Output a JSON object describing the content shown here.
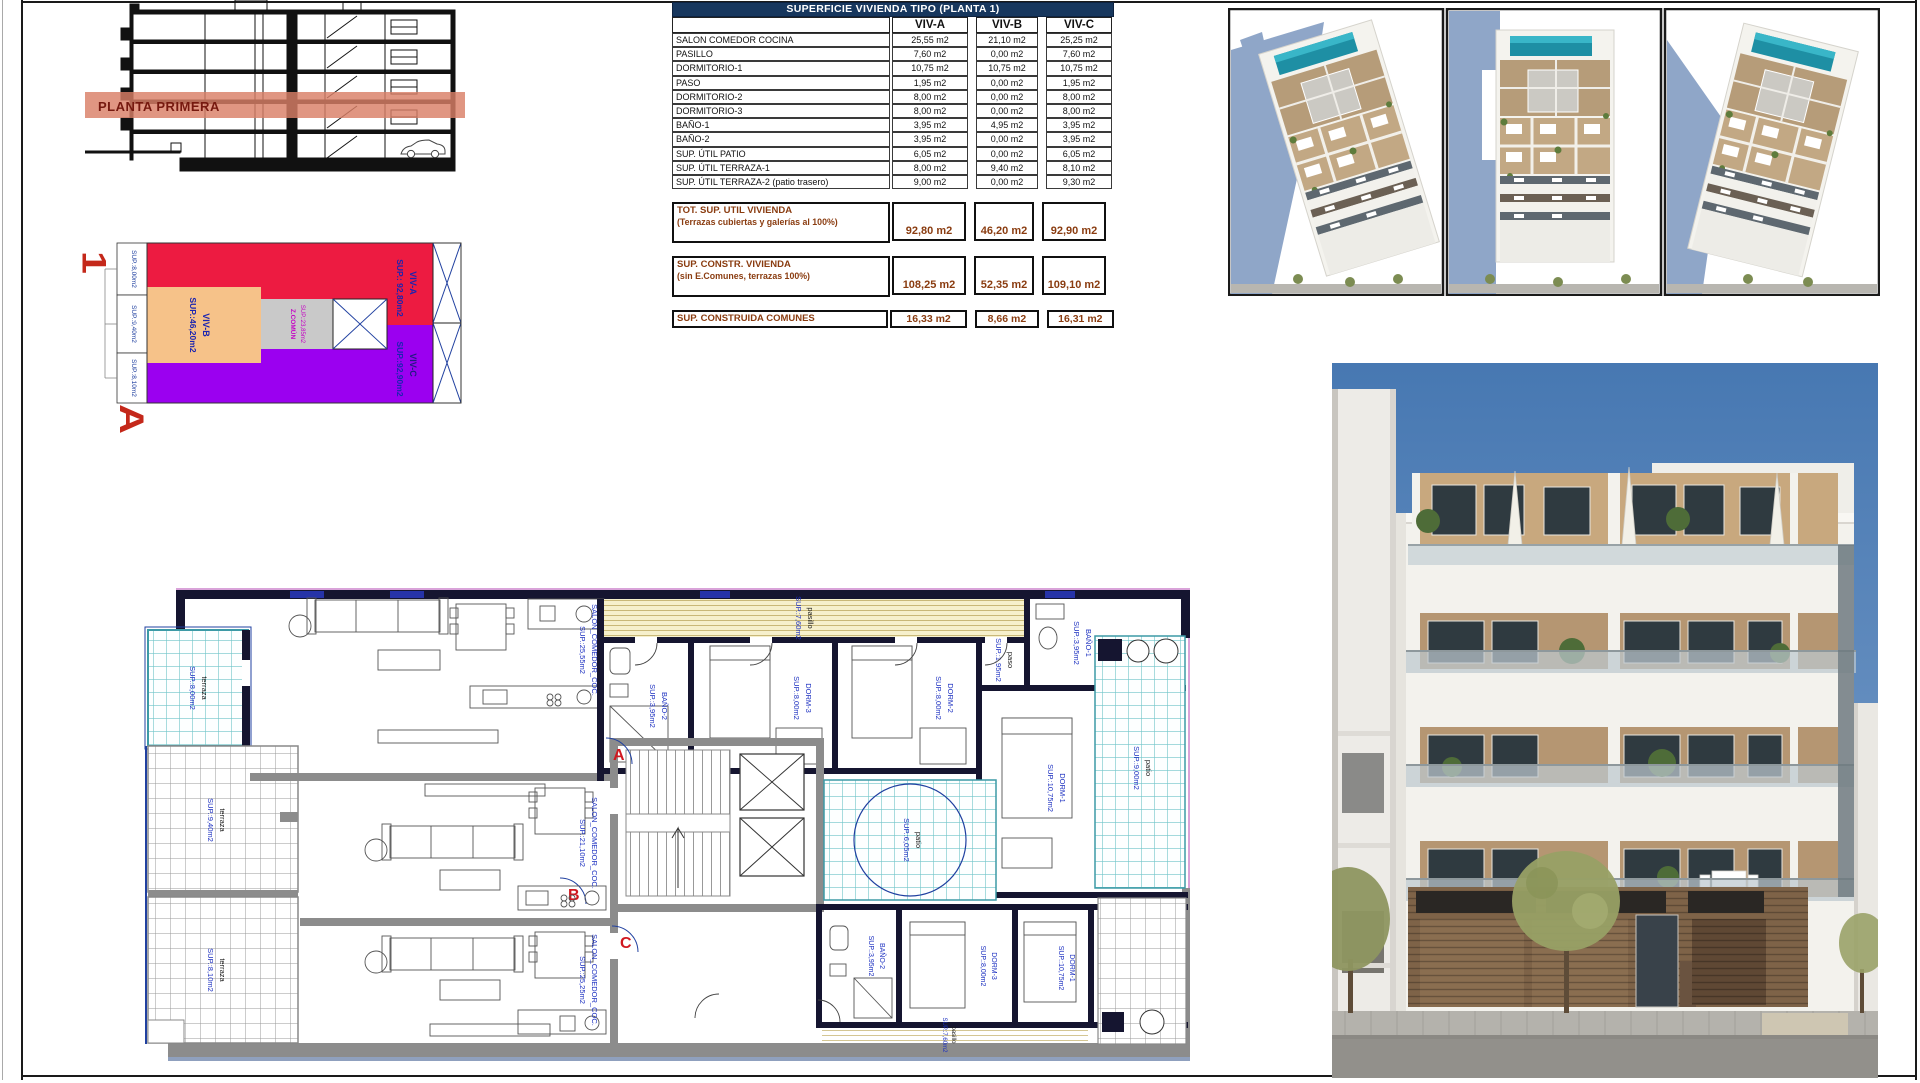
{
  "section": {
    "band_label": "PLANTA PRIMERA"
  },
  "key_plan": {
    "title": "PLANTA 1",
    "viv_a": {
      "name": "VIV-A",
      "sup": "SUP.: 92,80m2"
    },
    "viv_b": {
      "name": "VIV-B",
      "sup": "SUP.:46,20m2"
    },
    "viv_c": {
      "name": "VIV-C",
      "sup": "SUP.:92,90m2"
    },
    "z_comun": {
      "name": "Z.COMÚN",
      "sup": "SUP.:23,85m2"
    },
    "edge_labels": [
      "SUP.:8,00m2",
      "SUP.:9,40m2",
      "SUP.:8,10m2"
    ],
    "colors": {
      "viv_a": "#ED1B41",
      "viv_b": "#F6C289",
      "viv_c": "#9B00F0",
      "z_comun": "#C9C9C9"
    }
  },
  "table": {
    "title": "SUPERFICIE VIVIENDA TIPO (PLANTA 1)",
    "columns": [
      "VIV-A",
      "VIV-B",
      "VIV-C"
    ],
    "rows": [
      {
        "label": "SALON COMEDOR COCINA",
        "a": "25,55 m2",
        "b": "21,10 m2",
        "c": "25,25 m2"
      },
      {
        "label": "PASILLO",
        "a": "7,60 m2",
        "b": "0,00 m2",
        "c": "7,60 m2"
      },
      {
        "label": "DORMITORIO-1",
        "a": "10,75 m2",
        "b": "10,75 m2",
        "c": "10,75 m2"
      },
      {
        "label": "PASO",
        "a": "1,95 m2",
        "b": "0,00 m2",
        "c": "1,95 m2"
      },
      {
        "label": "DORMITORIO-2",
        "a": "8,00 m2",
        "b": "0,00 m2",
        "c": "8,00 m2"
      },
      {
        "label": "DORMITORIO-3",
        "a": "8,00 m2",
        "b": "0,00 m2",
        "c": "8,00 m2"
      },
      {
        "label": "BAÑO-1",
        "a": "3,95 m2",
        "b": "4,95 m2",
        "c": "3,95 m2"
      },
      {
        "label": "BAÑO-2",
        "a": "3,95 m2",
        "b": "0,00 m2",
        "c": "3,95 m2"
      },
      {
        "label": "SUP. ÚTIL PATIO",
        "a": "6,05 m2",
        "b": "0,00 m2",
        "c": "6,05 m2"
      },
      {
        "label": "SUP. ÚTIL TERRAZA-1",
        "a": "8,00 m2",
        "b": "9,40 m2",
        "c": "8,10 m2"
      },
      {
        "label": "SUP. ÚTIL TERRAZA-2 (patio trasero)",
        "a": "9,00 m2",
        "b": "0,00 m2",
        "c": "9,30 m2"
      }
    ],
    "totals": [
      {
        "label": "TOT. SUP. UTIL VIVIENDA",
        "sublabel": "(Terrazas cubiertas y galerías al 100%)",
        "a": "92,80 m2",
        "b": "46,20 m2",
        "c": "92,90 m2"
      },
      {
        "label": "SUP. CONSTR. VIVIENDA",
        "sublabel": "(sin E.Comunes, terrazas 100%)",
        "a": "108,25 m2",
        "b": "52,35 m2",
        "c": "109,10 m2"
      },
      {
        "label": "SUP. CONSTRUIDA COMUNES",
        "sublabel": "",
        "a": "16,33 m2",
        "b": "8,66 m2",
        "c": "16,31 m2"
      }
    ]
  },
  "floor_plan": {
    "badges": {
      "a": "A",
      "b": "B",
      "c": "C"
    },
    "salon_a": {
      "name": "SALON_COMEDOR_COC.",
      "sup": "SUP.:25,55m2"
    },
    "pasillo_a": {
      "name": "pasillo",
      "sup": "SUP.:7,60m2"
    },
    "bano2_a": {
      "name": "BAÑO-2",
      "sup": "SUP.:3,95m2"
    },
    "dorm3_a": {
      "name": "DORM-3",
      "sup": "SUP.:8,00m2"
    },
    "dorm2_a": {
      "name": "DORM-2",
      "sup": "SUP.:8,00m2"
    },
    "paso_a": {
      "name": "paso",
      "sup": "SUP.:1,95m2"
    },
    "bano1_a": {
      "name": "BAÑO-1",
      "sup": "SUP.:3,95m2"
    },
    "dorm1_a": {
      "name": "DORM-1",
      "sup": "SUP.:10,75m2"
    },
    "patio_a": {
      "name": "patio",
      "sup": "SUP.:6,05m2"
    },
    "terraza_a": {
      "name": "terraza",
      "sup": "SUP.:8,00m2"
    },
    "patio_trasero": {
      "name": "patio",
      "sup": "SUP.:9,00m2"
    },
    "salon_b": {
      "name": "SALON_COMEDOR_COC.",
      "sup": "SUP.:21,10m2"
    },
    "terraza_b": {
      "name": "terraza",
      "sup": "SUP.:9,40m2"
    },
    "salon_c": {
      "name": "SALON_COMEDOR_COC.",
      "sup": "SUP.:25,25m2"
    },
    "terraza_c": {
      "name": "terraza",
      "sup": "SUP.:8,10m2"
    },
    "bano2_c": {
      "name": "BAÑO-2",
      "sup": "SUP.:3,95m2"
    },
    "dorm3_c": {
      "name": "DORM-3",
      "sup": "SUP.:8,00m2"
    },
    "dorm1_c": {
      "name": "DORM-1",
      "sup": "SUP.:10,75m2"
    },
    "pasillo_c": {
      "name": "pasillo",
      "sup": "SUP.:7,60m2"
    }
  }
}
